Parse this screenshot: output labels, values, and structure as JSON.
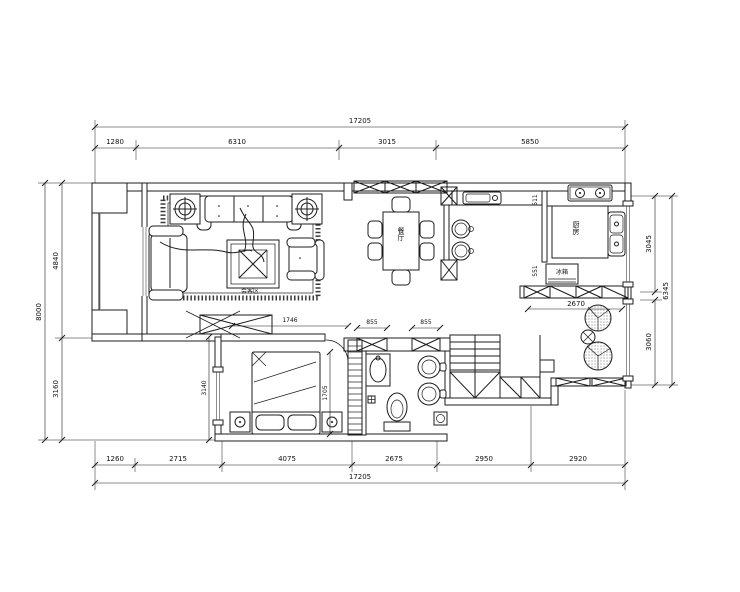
{
  "drawing": {
    "kind": "residential floor plan (CAD style)",
    "units": "mm"
  },
  "colors": {
    "line": "#1c1c1c",
    "window_glass": "#8f8f8f",
    "background": "#ffffff"
  },
  "dims": {
    "top": {
      "overall": "17205",
      "segments": [
        "1280",
        "6310",
        "3015",
        "5850"
      ]
    },
    "bottom": {
      "overall": "17205",
      "segments": [
        "1260",
        "2715",
        "4075",
        "2675",
        "2950",
        "2920"
      ]
    },
    "left": {
      "overall": "8000",
      "segments": [
        "4840",
        "3160"
      ]
    },
    "right": {
      "overall": "6345",
      "segments": [
        "3045",
        "3060"
      ]
    },
    "interior": {
      "bath_door_left": "855",
      "bath_door_right": "855",
      "balcony_width": "2670",
      "bed_width": "1746",
      "bed_length": "1705",
      "bedroom_depth": "3140",
      "kitchen_upper": "511",
      "kitchen_lower": "551"
    }
  },
  "rooms": {
    "living": {
      "label": "会客区"
    },
    "dining": {
      "label": "餐厅"
    },
    "kitchen": {
      "label": "厨房"
    },
    "appliances": {
      "fridge": "冰箱"
    }
  }
}
